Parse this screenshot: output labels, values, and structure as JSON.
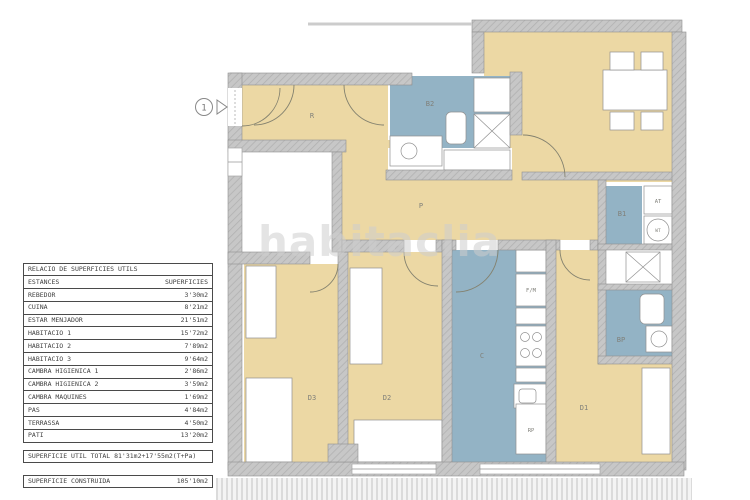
{
  "watermark": "habitaclia",
  "surface_table": {
    "title": "RELACIO DE SUPERFICIES UTILS",
    "columns": {
      "rooms": "ESTANCES",
      "surfaces": "SUPERFICIES"
    },
    "rows": [
      {
        "name": "REBEDOR",
        "value": "3'30m2"
      },
      {
        "name": "CUINA",
        "value": "8'21m2"
      },
      {
        "name": "ESTAR MENJADOR",
        "value": "21'51m2"
      },
      {
        "name": "HABITACIO 1",
        "value": "15'72m2"
      },
      {
        "name": "HABITACIO 2",
        "value": "7'89m2"
      },
      {
        "name": "HABITACIO 3",
        "value": "9'64m2"
      },
      {
        "name": "CAMBRA HIGIENICA 1",
        "value": "2'86m2"
      },
      {
        "name": "CAMBRA HIGIENICA 2",
        "value": "3'59m2"
      },
      {
        "name": "CAMBRA MAQUINES",
        "value": "1'69m2"
      },
      {
        "name": "PAS",
        "value": "4'84m2"
      },
      {
        "name": "TERRASSA",
        "value": "4'50m2"
      },
      {
        "name": "PATI",
        "value": "13'20m2"
      }
    ],
    "total": "SUPERFICIE UTIL TOTAL 81'31m2+17'55m2(T+Pa)",
    "built": {
      "label": "SUPERFICIE CONSTRUIDA",
      "value": "105'10m2"
    }
  },
  "plan": {
    "entrance_number": "1",
    "labels": {
      "rebedor": "R",
      "pas": "P",
      "cuina": "C",
      "bany_1": "B1",
      "bany_2": "B2",
      "bany_p": "BP",
      "dormitori_1": "D1",
      "dormitori_2": "D2",
      "dormitori_3": "D3",
      "armari": "AT",
      "termo": "WT",
      "nevera": "F/M",
      "rentador": "RP"
    },
    "colors": {
      "room_beige": "#ecd8a4",
      "wet_room_blue": "#93b3c5",
      "wall_gray": "#c7c7c7"
    }
  }
}
